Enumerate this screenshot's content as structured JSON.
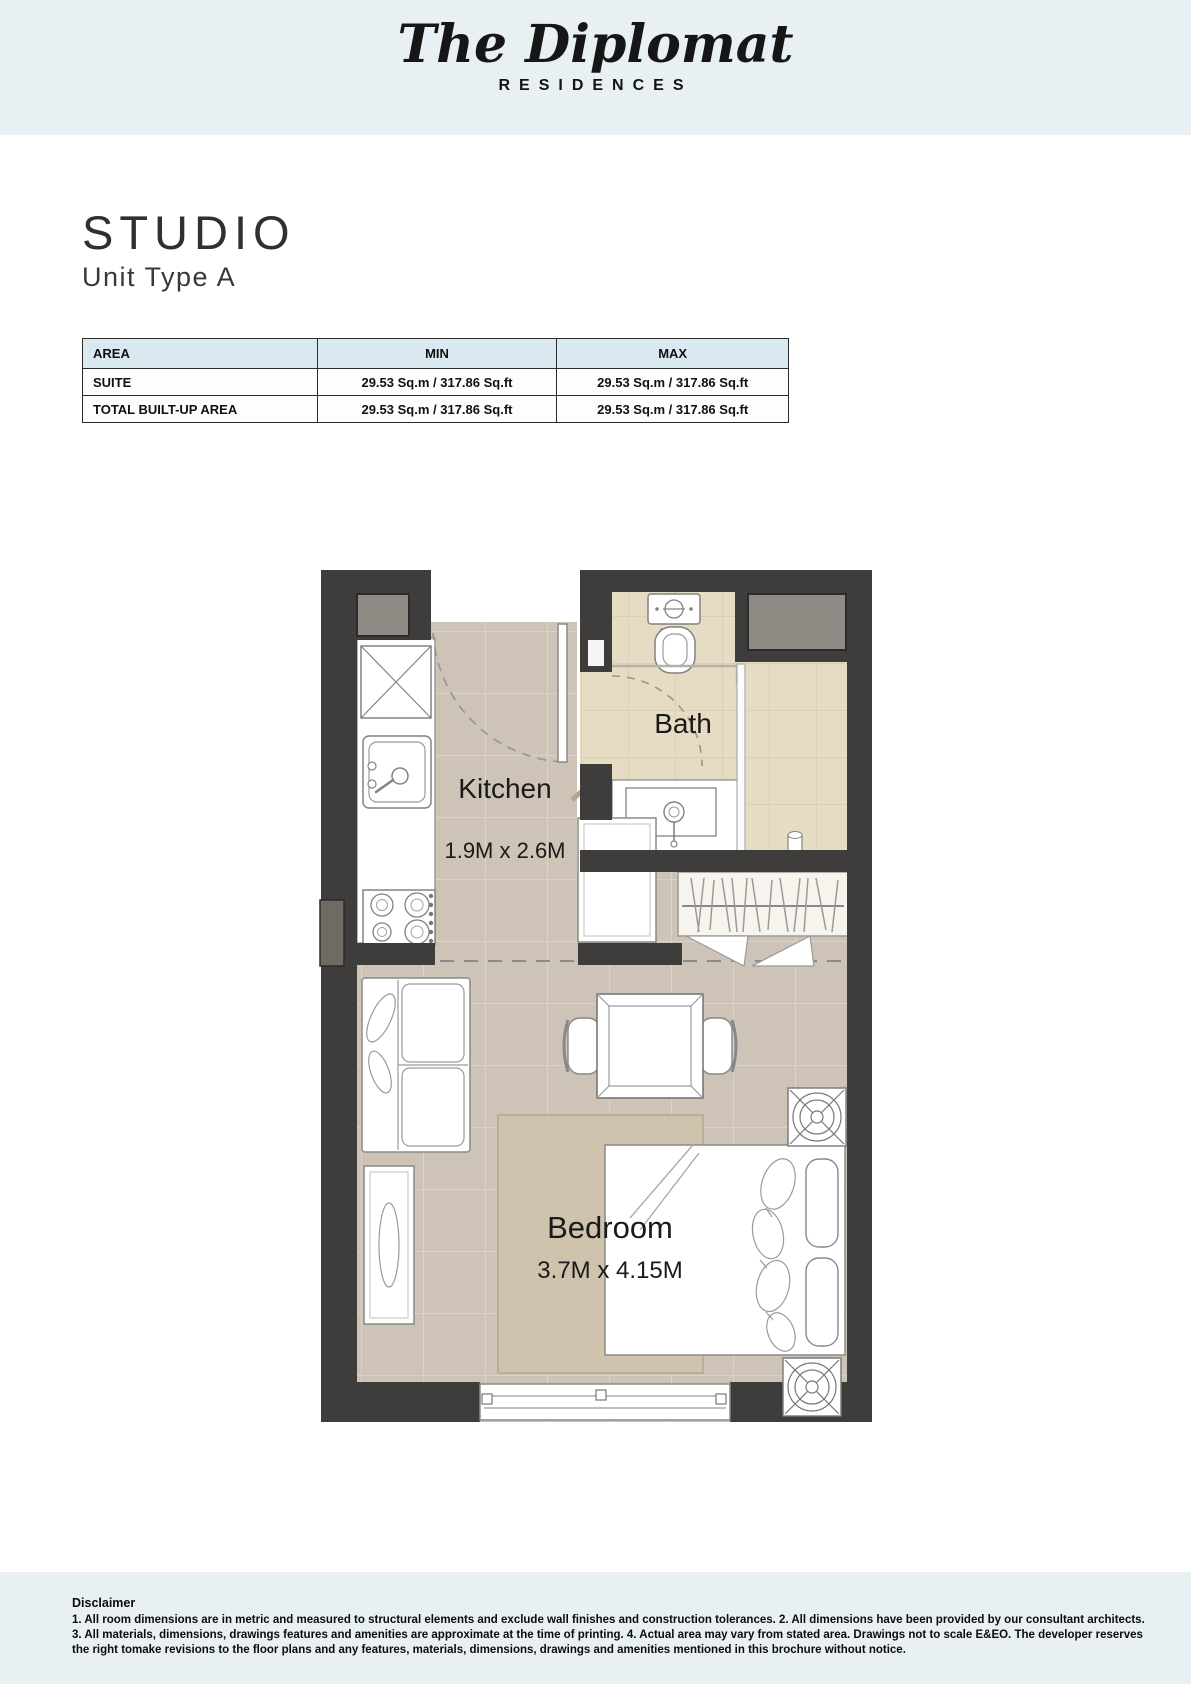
{
  "header": {
    "brand_script": "The Diplomat",
    "brand_sub": "RESIDENCES",
    "band_color": "#e8f0f3"
  },
  "title": {
    "main": "STUDIO",
    "subtitle": "Unit Type A"
  },
  "area_table": {
    "columns": [
      "AREA",
      "MIN",
      "MAX"
    ],
    "header_bg": "#dae9f0",
    "rows": [
      {
        "label": "SUITE",
        "min": "29.53 Sq.m / 317.86 Sq.ft",
        "max": "29.53 Sq.m / 317.86 Sq.ft"
      },
      {
        "label": "TOTAL BUILT-UP AREA",
        "min": "29.53 Sq.m / 317.86 Sq.ft",
        "max": "29.53 Sq.m / 317.86 Sq.ft"
      }
    ]
  },
  "floor_plan": {
    "rooms": {
      "kitchen": {
        "name": "Kitchen",
        "dimensions": "1.9M x 2.6M"
      },
      "bath": {
        "name": "Bath"
      },
      "bedroom": {
        "name": "Bedroom",
        "dimensions": "3.7M x 4.15M"
      }
    },
    "colors": {
      "wall": "#3e3d3b",
      "floor": "#cdc3b6",
      "bath_floor": "#e6dcc4",
      "rug": "#cfc3ad",
      "shaft": "#8f8b84"
    },
    "features": [
      "entry-door",
      "fridge",
      "kitchen-sink",
      "stove",
      "kitchen-counter",
      "toilet",
      "vanity-sink",
      "shower",
      "shower-glass",
      "bath-door",
      "wardrobe",
      "entry-closet",
      "sofa",
      "tv-console",
      "dining-table",
      "dining-chair",
      "bed",
      "pillow",
      "rug",
      "window",
      "ac-unit",
      "service-shaft",
      "wall-panel"
    ]
  },
  "footer": {
    "band_color": "#e8f0f3",
    "disclaimer_title": "Disclaimer",
    "disclaimer_lines": [
      "1. All room dimensions are in metric and measured to structural elements and exclude wall finishes and construction tolerances. 2. All dimensions have been provided by our consultant architects.",
      "3. All materials, dimensions, drawings features and amenities are approximate at the time of printing. 4. Actual area may vary from stated area. Drawings not to scale E&EO. The developer reserves",
      "the right tomake revisions to the floor plans and any features, materials, dimensions, drawings and amenities mentioned in this brochure without notice."
    ]
  }
}
